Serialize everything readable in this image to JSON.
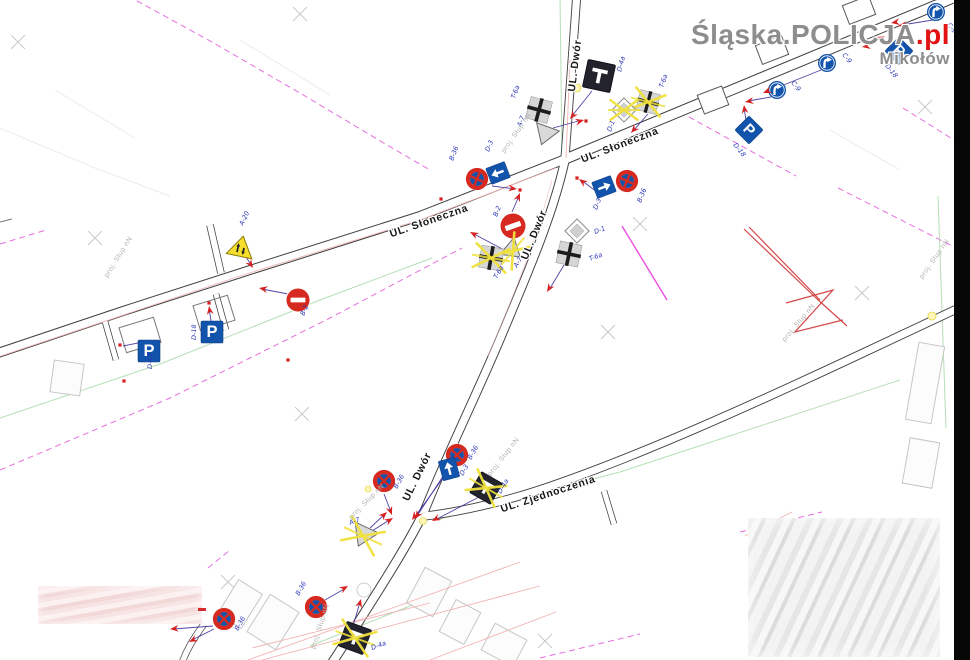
{
  "watermark": {
    "brand": "Śląska.POLICJA",
    "suffix": ".pl",
    "city": "Mikołów"
  },
  "glyphs": {
    "parking": "P"
  },
  "colors": {
    "sign_blue": "#1254ac",
    "sign_red": "#d62a20",
    "marker_red": "#d62020",
    "leader": "#41309b",
    "cross_yellow": "#f0e13c",
    "label_blue": "#2b36b8",
    "street_text": "#161616",
    "note_grey": "#b3b3b3",
    "grey_sign": "#d6d6d6",
    "dark_sign": "#23232e",
    "warn_yellow": "#f6de2f"
  },
  "streets": [
    {
      "name": "UL. Dwór",
      "x": 578,
      "y": 66,
      "rot": -83
    },
    {
      "name": "UL. Słoneczna",
      "x": 621,
      "y": 148,
      "rot": -21
    },
    {
      "name": "UL. Słoneczna",
      "x": 430,
      "y": 224,
      "rot": -19
    },
    {
      "name": "UL. Dwór",
      "x": 537,
      "y": 236,
      "rot": -68
    },
    {
      "name": "UL. Dwór",
      "x": 420,
      "y": 478,
      "rot": -64
    },
    {
      "name": "UL. Zjednoczenia",
      "x": 549,
      "y": 497,
      "rot": -18
    }
  ],
  "annotation": {
    "text": "proj. Słup nN",
    "placements": [
      [
        120,
        258,
        -58
      ],
      [
        518,
        134,
        -55
      ],
      [
        505,
        458,
        -52
      ],
      [
        368,
        503,
        -45
      ],
      [
        322,
        627,
        -72
      ],
      [
        800,
        324,
        -50
      ],
      [
        936,
        260,
        -55
      ]
    ]
  },
  "signs": [
    {
      "c": "C-9",
      "t": "c9",
      "x": 936,
      "y": 12,
      "s": 9,
      "r": 0,
      "lb": [
        947,
        25,
        52
      ],
      "ld": [
        [
          933,
          20,
          902,
          25
        ]
      ],
      "ar": [
        [
          898,
          26,
          171
        ]
      ]
    },
    {
      "c": "D-18",
      "t": "d18",
      "x": 899,
      "y": 51,
      "s": 10,
      "r": 45,
      "lb": [
        885,
        66,
        52
      ],
      "ld": [
        [
          894,
          43,
          879,
          39
        ]
      ],
      "ar": [
        [
          876,
          37,
          198
        ]
      ]
    },
    {
      "c": "C-9",
      "t": "c9",
      "x": 827,
      "y": 63,
      "s": 9,
      "r": 0,
      "lb": [
        842,
        55,
        52
      ],
      "ld": [
        [
          821,
          70,
          766,
          92
        ]
      ],
      "ar": [
        [
          763,
          93,
          158
        ]
      ]
    },
    {
      "c": "C-9",
      "t": "c9",
      "x": 777,
      "y": 90,
      "s": 9,
      "r": 0,
      "lb": [
        791,
        83,
        52
      ],
      "ld": [
        [
          771,
          97,
          748,
          101
        ]
      ],
      "ar": [
        [
          745,
          102,
          170
        ]
      ]
    },
    {
      "c": "D-18",
      "t": "d18",
      "x": 749,
      "y": 130,
      "s": 10,
      "r": 45,
      "lb": [
        733,
        145,
        52
      ],
      "ld": [
        [
          746,
          120,
          744,
          108
        ]
      ],
      "ar": [
        [
          744,
          105,
          263
        ]
      ]
    },
    {
      "c": "D-4a",
      "t": "d4a",
      "x": 599,
      "y": 76,
      "s": 14,
      "r": 12,
      "lb": [
        621,
        72,
        -75
      ],
      "ld": [
        [
          592,
          91,
          572,
          116
        ]
      ],
      "ar": [
        [
          570,
          119,
          129
        ]
      ]
    },
    {
      "c": "T-6a",
      "t": "t6a",
      "x": 539,
      "y": 110,
      "s": 12,
      "r": 15,
      "lb": [
        515,
        99,
        -70
      ]
    },
    {
      "c": "A-7",
      "t": "a7",
      "x": 545,
      "y": 135,
      "s": 12,
      "r": 20,
      "lb": [
        521,
        127,
        -70
      ],
      "ld": [
        [
          553,
          128,
          582,
          120
        ]
      ],
      "ar": [
        [
          584,
          120,
          -15
        ]
      ],
      "dt": [
        [
          586,
          121
        ]
      ]
    },
    {
      "c": "T-6a",
      "t": "t6a",
      "x": 648,
      "y": 102,
      "s": 11,
      "r": 15,
      "crossed": true,
      "lb": [
        663,
        88,
        -70
      ]
    },
    {
      "c": "D-1",
      "t": "d1",
      "x": 624,
      "y": 110,
      "s": 10,
      "r": 0,
      "crossed": true,
      "lb": [
        611,
        132,
        -70
      ],
      "ld": [
        [
          648,
          114,
          633,
          131
        ]
      ],
      "ar": [
        [
          631,
          133,
          131
        ]
      ]
    },
    {
      "c": "D-3",
      "t": "d3",
      "x": 498,
      "y": 173,
      "s": 10,
      "r": -111,
      "lb": [
        489,
        152,
        -68
      ],
      "ld": [
        [
          492,
          186,
          515,
          189
        ]
      ],
      "ar": [
        [
          517,
          189,
          7
        ]
      ],
      "dt": [
        [
          520,
          190
        ],
        [
          441,
          199
        ]
      ]
    },
    {
      "c": "B-36",
      "t": "b36",
      "x": 477,
      "y": 179,
      "s": 12,
      "r": -21,
      "lb": [
        453,
        161,
        -68
      ]
    },
    {
      "c": "D-3",
      "t": "d3",
      "x": 604,
      "y": 187,
      "s": 10,
      "r": 69,
      "lb": [
        597,
        210,
        -68
      ],
      "ld": [
        [
          597,
          192,
          581,
          180
        ]
      ],
      "ar": [
        [
          579,
          179,
          217
        ]
      ],
      "dt": [
        [
          577,
          178
        ]
      ]
    },
    {
      "c": "B-36",
      "t": "b36",
      "x": 627,
      "y": 181,
      "s": 12,
      "r": -21,
      "lb": [
        641,
        203,
        -68
      ]
    },
    {
      "c": "B-2",
      "t": "b2",
      "x": 513,
      "y": 226,
      "s": 13,
      "r": -20,
      "lb": [
        497,
        217,
        -68
      ],
      "ld": [
        [
          512,
          212,
          519,
          196
        ]
      ],
      "ar": [
        [
          520,
          193,
          -68
        ]
      ]
    },
    {
      "c": "A-7",
      "t": "a7",
      "x": 513,
      "y": 251,
      "s": 11,
      "r": -50,
      "crossed": true,
      "lb": [
        517,
        268,
        -60
      ]
    },
    {
      "c": "T-6a",
      "t": "t6a",
      "x": 491,
      "y": 258,
      "s": 12,
      "r": 10,
      "crossed": true,
      "lb": [
        497,
        279,
        -60
      ],
      "ld": [
        [
          510,
          253,
          472,
          233
        ]
      ],
      "ar": [
        [
          470,
          232,
          208
        ]
      ]
    },
    {
      "c": "D-1",
      "t": "d1",
      "x": 577,
      "y": 231,
      "s": 10,
      "r": 0,
      "lb": [
        595,
        234,
        -20
      ]
    },
    {
      "c": "T-6a",
      "t": "t6a",
      "x": 569,
      "y": 254,
      "s": 12,
      "r": 12,
      "lb": [
        590,
        261,
        -20
      ],
      "ld": [
        [
          564,
          265,
          549,
          290
        ]
      ],
      "ar": [
        [
          547,
          292,
          121
        ]
      ]
    },
    {
      "c": "A-20",
      "t": "a20",
      "x": 241,
      "y": 247,
      "s": 13,
      "r": 12,
      "lb": [
        243,
        226,
        -65
      ],
      "ld": [
        [
          246,
          257,
          252,
          266
        ]
      ],
      "ar": [
        [
          253,
          268,
          56
        ]
      ]
    },
    {
      "c": "B-2",
      "t": "b2",
      "x": 298,
      "y": 300,
      "s": 12,
      "r": 0,
      "lb": [
        304,
        316,
        -65
      ],
      "ld": [
        [
          288,
          294,
          262,
          289
        ]
      ],
      "ar": [
        [
          259,
          288,
          191
        ]
      ]
    },
    {
      "c": "D-18",
      "t": "d18",
      "x": 212,
      "y": 332,
      "s": 11,
      "r": 0,
      "lb": [
        196,
        340,
        -90
      ],
      "ld": [
        [
          211,
          321,
          209,
          308
        ]
      ],
      "ar": [
        [
          209,
          306,
          -99
        ]
      ],
      "dt": [
        [
          209,
          303
        ]
      ]
    },
    {
      "c": "D-18",
      "t": "d18",
      "x": 149,
      "y": 351,
      "s": 11,
      "r": 0,
      "lb": [
        152,
        369,
        -90
      ],
      "ld": [
        [
          143,
          342,
          123,
          346
        ]
      ],
      "dt": [
        [
          120,
          345
        ]
      ]
    },
    {
      "c": "B-36",
      "t": "b36",
      "x": 457,
      "y": 455,
      "s": 12,
      "r": 0,
      "lb": [
        471,
        460,
        -60
      ],
      "ld": [
        [
          451,
          464,
          417,
          516
        ]
      ],
      "ar": [
        [
          415,
          519,
          123
        ]
      ]
    },
    {
      "c": "D-3",
      "t": "d3",
      "x": 449,
      "y": 469,
      "s": 10,
      "r": -15,
      "lb": [
        463,
        476,
        -60
      ],
      "ld": [
        [
          443,
          478,
          414,
          518
        ]
      ],
      "ar": [
        [
          412,
          520,
          126
        ]
      ]
    },
    {
      "c": "D-4a",
      "t": "d4a",
      "x": 486,
      "y": 488,
      "s": 12,
      "r": 30,
      "crossed": true,
      "lb": [
        501,
        494,
        -60
      ],
      "ld": [
        [
          479,
          497,
          435,
          520
        ]
      ],
      "ar": [
        [
          432,
          521,
          152
        ]
      ]
    },
    {
      "c": "B-36",
      "t": "b36",
      "x": 384,
      "y": 481,
      "s": 12,
      "r": 0,
      "lb": [
        397,
        489,
        -60
      ],
      "ld": [
        [
          384,
          494,
          391,
          512
        ]
      ],
      "ar": [
        [
          392,
          515,
          69
        ]
      ]
    },
    {
      "c": "A-7",
      "t": "a7",
      "x": 363,
      "y": 536,
      "s": 13,
      "r": 25,
      "crossed": true,
      "lb": [
        350,
        525,
        -20
      ],
      "ld": [
        [
          370,
          528,
          385,
          514
        ],
        [
          372,
          531,
          391,
          519
        ]
      ],
      "ar": [
        [
          387,
          512,
          -43
        ],
        [
          393,
          518,
          -32
        ]
      ]
    },
    {
      "c": "B-36",
      "t": "b36",
      "x": 224,
      "y": 619,
      "s": 12,
      "r": 0,
      "lb": [
        238,
        631,
        -60
      ],
      "ld": [
        [
          213,
          626,
          173,
          629
        ],
        [
          214,
          629,
          192,
          640
        ]
      ],
      "ar": [
        [
          170,
          629,
          176
        ],
        [
          189,
          642,
          153
        ]
      ]
    },
    {
      "c": "B-36",
      "t": "b36",
      "x": 316,
      "y": 607,
      "s": 12,
      "r": 0,
      "lb": [
        299,
        596,
        -60
      ],
      "ld": [
        [
          325,
          600,
          346,
          588
        ]
      ],
      "ar": [
        [
          348,
          586,
          -30
        ]
      ]
    },
    {
      "c": "D-4a",
      "t": "d4a",
      "x": 355,
      "y": 638,
      "s": 13,
      "r": 20,
      "crossed": true,
      "lb": [
        372,
        650,
        -20
      ],
      "ld": [
        [
          353,
          626,
          360,
          602
        ]
      ],
      "ar": [
        [
          361,
          599,
          -74
        ]
      ]
    }
  ],
  "stray_markers": {
    "arrows": [
      [
        891,
        23,
        171
      ],
      [
        862,
        47,
        171
      ]
    ],
    "dots": [
      [
        124,
        381
      ],
      [
        288,
        360
      ]
    ]
  }
}
